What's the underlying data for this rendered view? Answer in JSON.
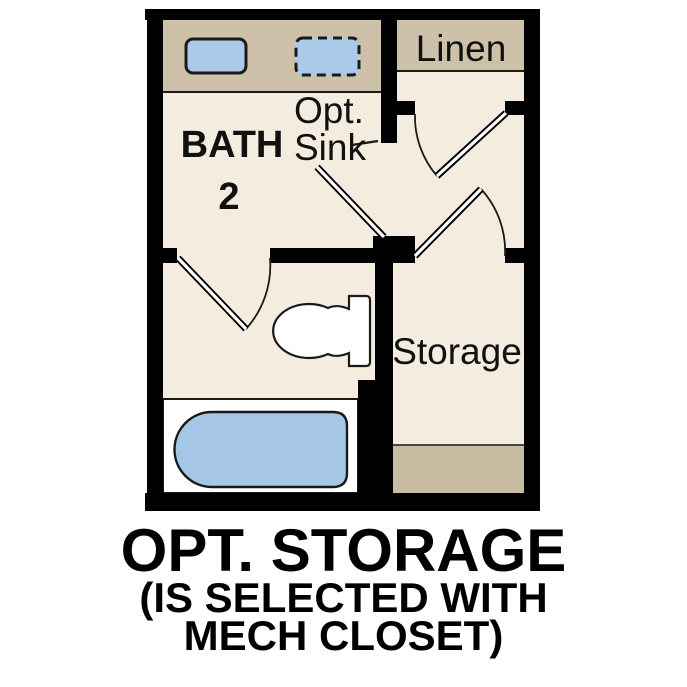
{
  "plan": {
    "rooms": {
      "bath": {
        "label_line1": "BATH",
        "label_line2": "2"
      },
      "linen": {
        "label": "Linen"
      },
      "storage": {
        "label": "Storage"
      }
    },
    "annotations": {
      "opt_sink_line1": "Opt.",
      "opt_sink_line2": "Sink"
    },
    "fixtures": {
      "vanity_counter": "vanity-counter",
      "sink": "sink",
      "optional_sink": "optional-sink-dashed",
      "toilet": "toilet",
      "bathtub": "bathtub",
      "linen_shelf": "linen-shelf",
      "storage_shelf": "storage-shelf"
    },
    "colors": {
      "wall": "#000000",
      "floor": "#f3ecdf",
      "counter": "#cdc1a9",
      "shelf": "#c7bba2",
      "sink": "#abc9e8",
      "tub": "#a6c6e6",
      "fixture_white": "#ffffff",
      "outline": "#1a1a1a",
      "text": "#111111"
    }
  },
  "caption": {
    "line1": "OPT. STORAGE",
    "line2": "(IS SELECTED WITH",
    "line3": "MECH CLOSET)"
  }
}
